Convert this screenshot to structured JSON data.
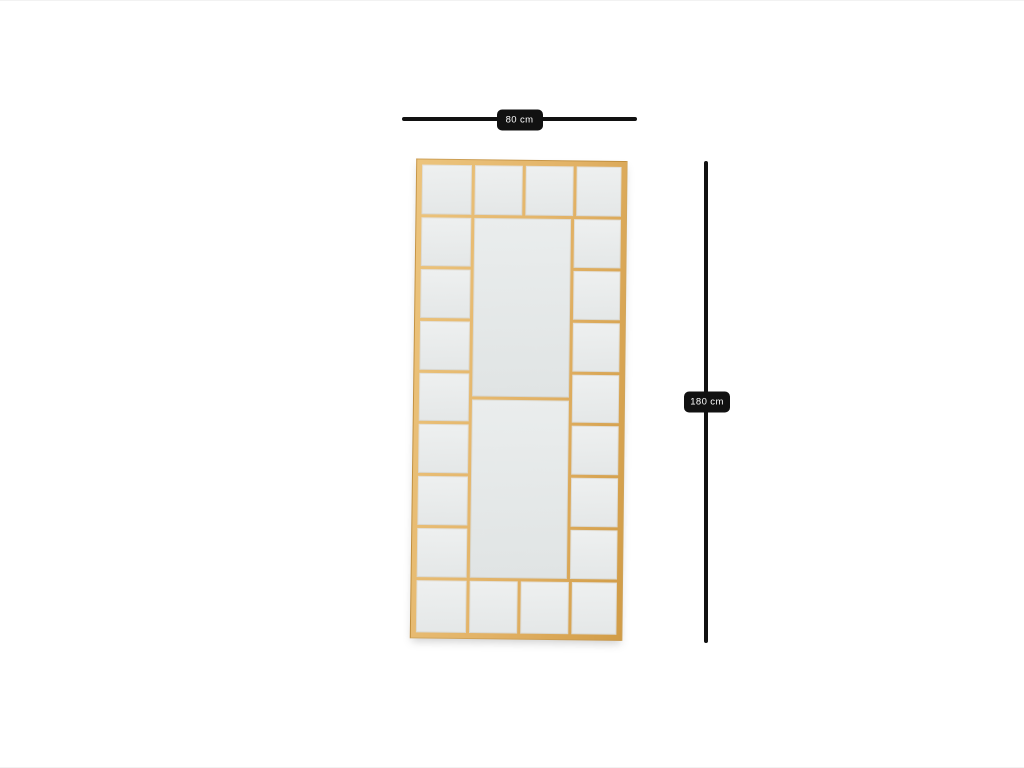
{
  "page": {
    "background": "#ffffff",
    "description": "Product dimension diagram of a gold window-pane floor mirror"
  },
  "product": {
    "name": "gold-window-pane-mirror",
    "frame_color": "#e2b266",
    "frame_color_light": "#ecc47d",
    "frame_color_dark": "#d19c46",
    "pane_color_light": "#eef0f0",
    "pane_color_dark": "#e4e7e7",
    "grid": {
      "top_row_panes": 4,
      "bottom_row_panes": 4,
      "left_column_panes": 7,
      "right_column_panes": 7,
      "center_panels": 2
    }
  },
  "dimensions": {
    "width_label": "80 cm",
    "height_label": "180 cm",
    "line_color": "#111111",
    "label_bg": "#111111",
    "label_text_color": "#ffffff"
  }
}
